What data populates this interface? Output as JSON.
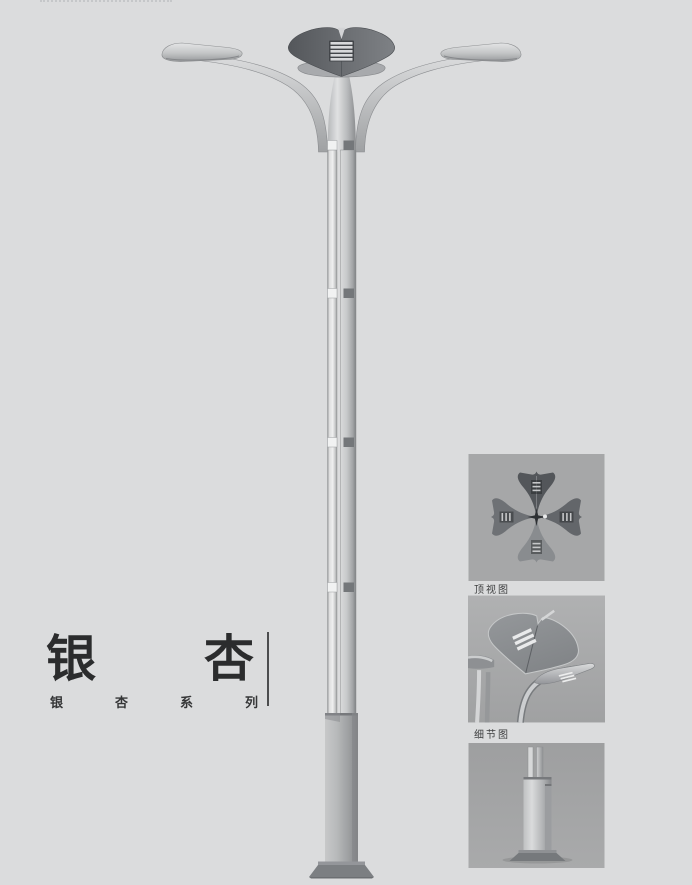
{
  "page": {
    "background_color": "#dbdcdd",
    "kind": "street-lamp-product-catalog-page"
  },
  "title_block": {
    "main_text": "银杏",
    "main_chars": [
      "银",
      "杏"
    ],
    "series_text": "银杏系列",
    "series_chars": [
      "银",
      "杏",
      "系",
      "列"
    ]
  },
  "lamp_render": {
    "parts": [
      "ginkgo-canopy-leaf",
      "canopy-louvers",
      "under-leaf",
      "left-arm",
      "right-arm",
      "left-lamp-head",
      "right-lamp-head",
      "twin-tube-pole",
      "pole-joint-bands",
      "base-column",
      "anchor-base-plate"
    ],
    "pole_joint_count": 4
  },
  "detail_panels": [
    {
      "label": "顶视图",
      "content": "top-view-four-ginkgo-leaf-canopy"
    },
    {
      "label": "细节图",
      "content": "close-up-leaf-canopy-and-lamp-arm"
    },
    {
      "label": "",
      "content": "pole-base-with-anchor-plate"
    }
  ],
  "colors": {
    "page_background": "#dbdcdd",
    "panel_background": "#a6a7a8",
    "canopy_dark": "#5a5d61",
    "metal_light": "#d8d9da",
    "metal_dark": "#8f9193",
    "text": "#2e2f30"
  }
}
